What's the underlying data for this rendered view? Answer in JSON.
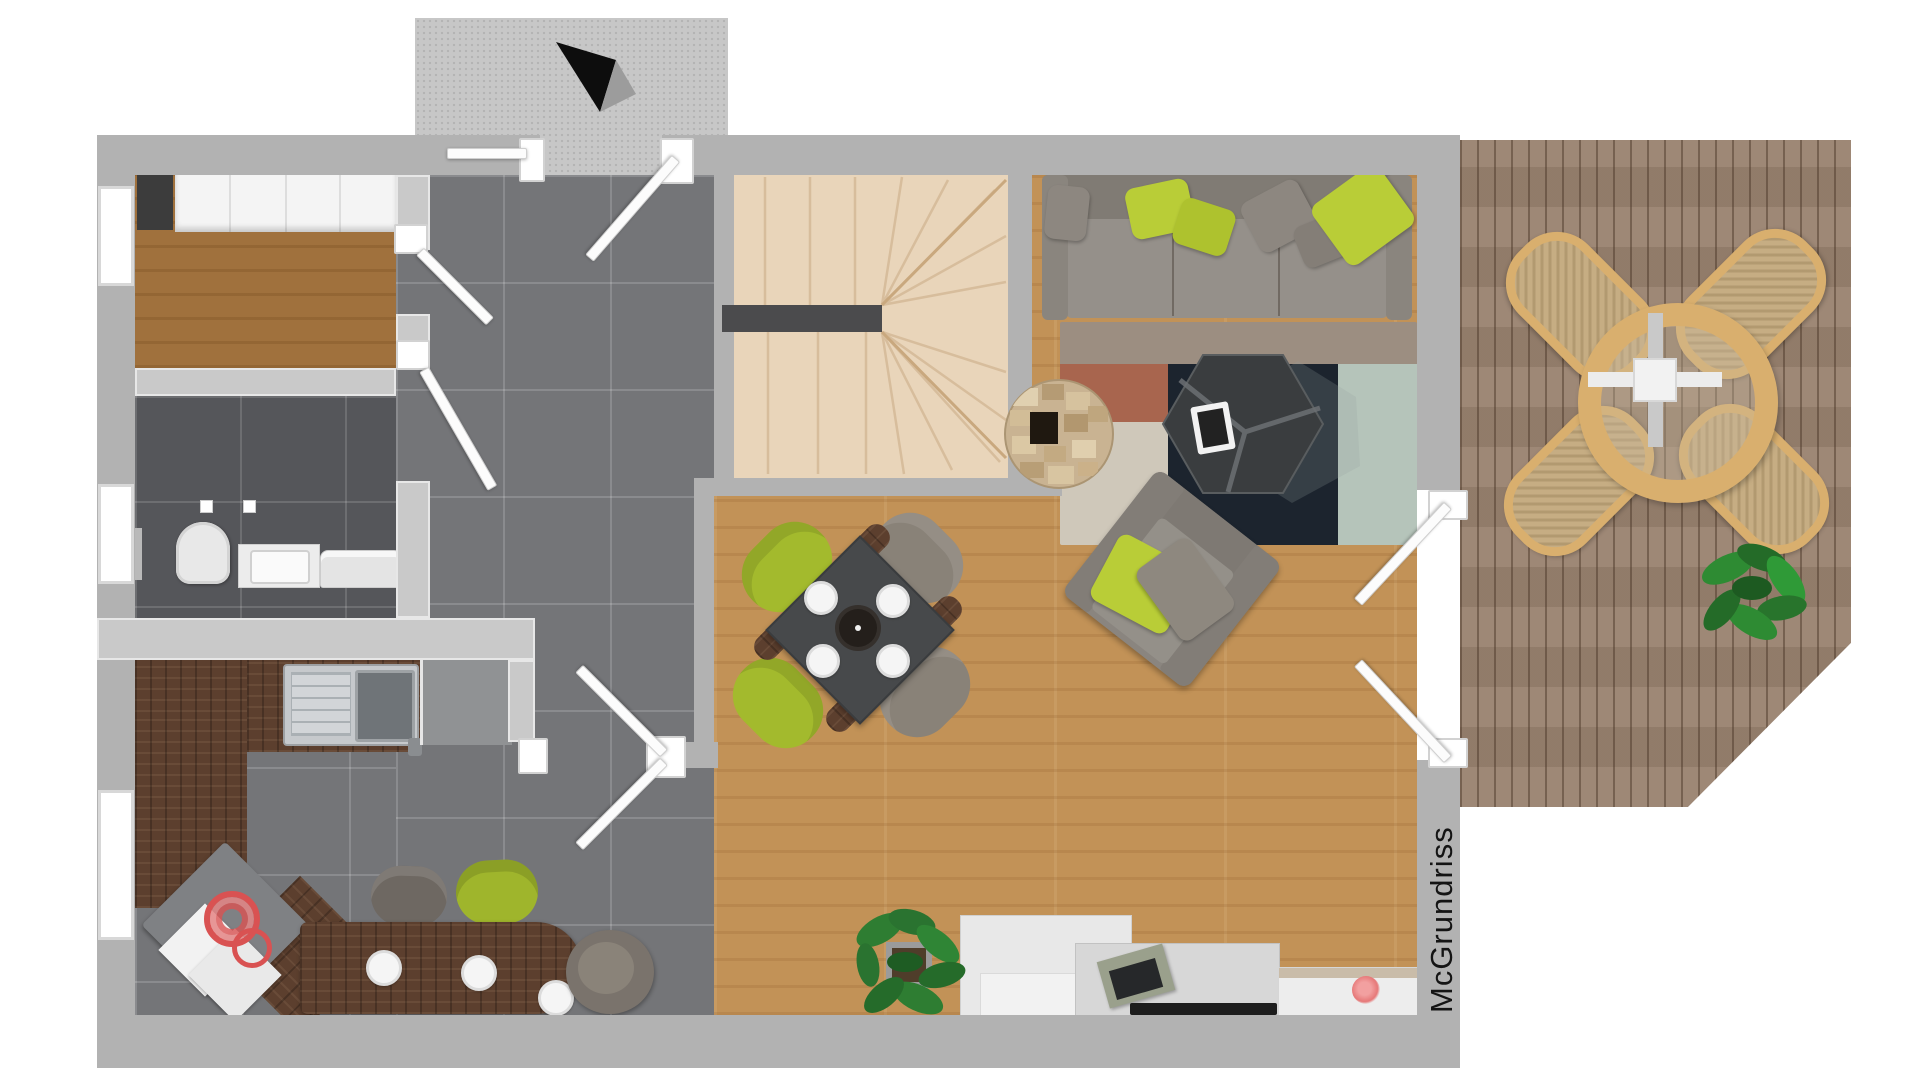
{
  "watermark": {
    "text": "McGrundriss"
  },
  "palette": {
    "outer_wall": "#b2b2b2",
    "inner_wall": "#c9c9c9",
    "hall_tile": "#747578",
    "bath_tile": "#55565a",
    "living_wood": "#c29257",
    "room_wood": "#a0713d",
    "kitchen_walnut": "#5c3f2e",
    "stairs": "#e9d5ba",
    "deck": "#99826f",
    "accent_green": "#a9bf2e",
    "sofa_gray": "#8a857f",
    "rug_navy": "#1c242e",
    "rug_rust": "#a8654e",
    "rug_sage": "#b5c4ba",
    "rug_taupe": "#9c8e81",
    "flower_pink": "#e67878",
    "cooktop_red": "#d95252",
    "terrace_rattan": "#d9af6e"
  },
  "legend": {
    "type": "floor-plan",
    "rooms": [
      "entrance-vestibule",
      "hallway",
      "storage-room",
      "bathroom",
      "kitchen",
      "living-dining-room",
      "staircase",
      "terrace"
    ],
    "furniture": [
      "wardrobe",
      "toilet",
      "washbasin",
      "washing-machine",
      "kitchen-sink",
      "fridge-cabinet",
      "cooktop",
      "bar-counter",
      "bar-chairs",
      "dining-table",
      "dining-chairs",
      "corner-sofa",
      "coffee-table",
      "armchair",
      "rug",
      "log-side-table",
      "tv-sideboard",
      "media-unit",
      "potted-plant",
      "terrace-table",
      "terrace-chairs",
      "terrace-plant"
    ],
    "compass": "north-arrow"
  }
}
